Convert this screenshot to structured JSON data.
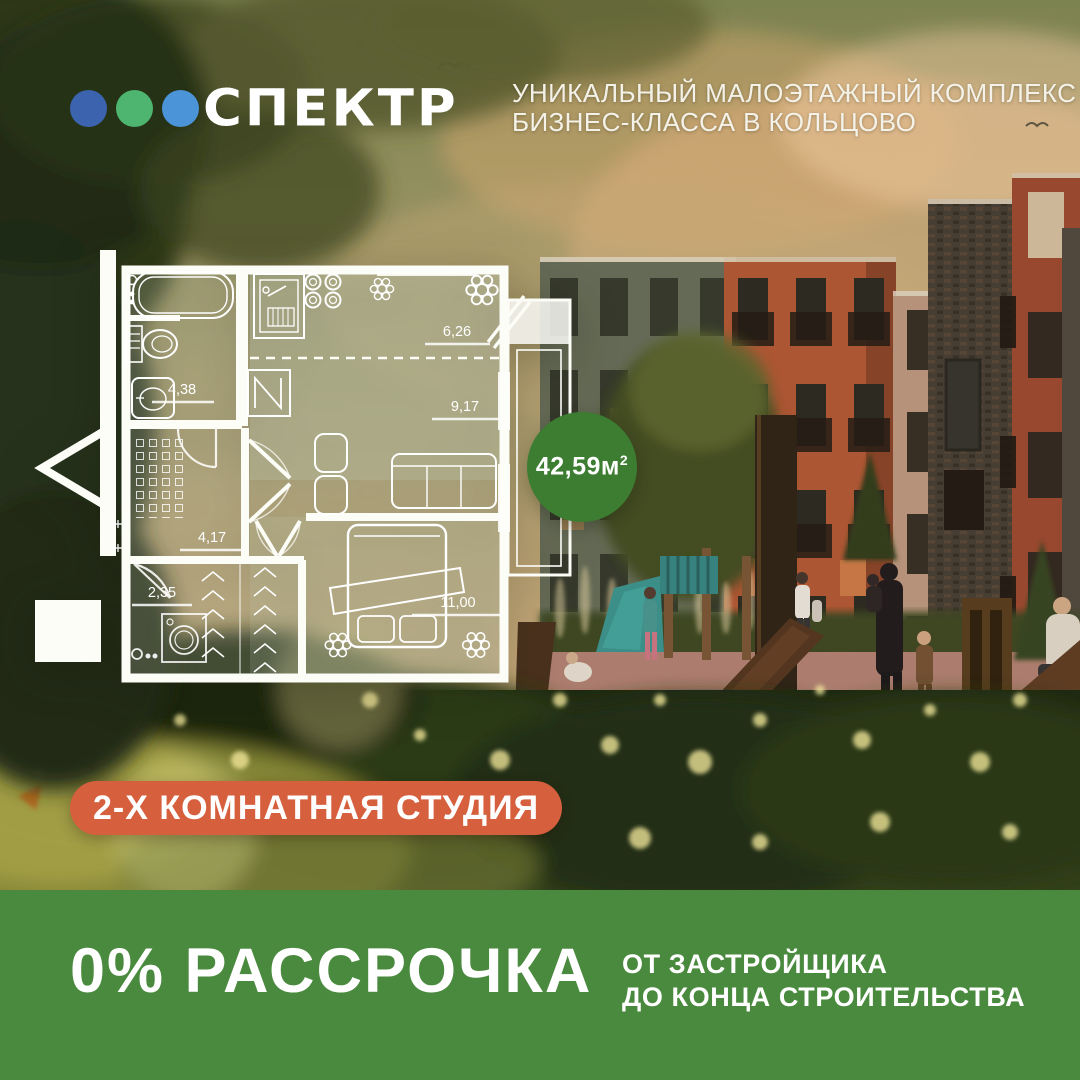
{
  "brand": {
    "name": "СПЕКТР"
  },
  "tagline": {
    "line1": "УНИКАЛЬНЫЙ МАЛОЭТАЖНЫЙ КОМПЛЕКС",
    "line2": "БИЗНЕС-КЛАССА В КОЛЬЦОВО"
  },
  "floorplan": {
    "total_area": {
      "value": "42,59м",
      "sup": "2"
    },
    "rooms": [
      {
        "name": "bathroom",
        "label": "4,38"
      },
      {
        "name": "kitchen-zone",
        "label": "6,26"
      },
      {
        "name": "living-zone",
        "label": "9,17"
      },
      {
        "name": "hallway",
        "label": "4,17"
      },
      {
        "name": "storage",
        "label": "2,35"
      },
      {
        "name": "bedroom",
        "label": "11,00"
      }
    ]
  },
  "badge": {
    "apartment_type": "2-Х КОМНАТНАЯ СТУДИЯ"
  },
  "footer": {
    "offer": "0% РАССРОЧКА",
    "sub_line1": "ОТ ЗАСТРОЙЩИКА",
    "sub_line2": "ДО КОНЦА СТРОИТЕЛЬСТВА"
  },
  "colors": {
    "footer_band": "#4a8a3e",
    "type_badge": "#d65f3e",
    "area_badge": "#3c7d31",
    "logo_dots": [
      "#3b63ae",
      "#4db56f",
      "#4b94d8"
    ]
  }
}
